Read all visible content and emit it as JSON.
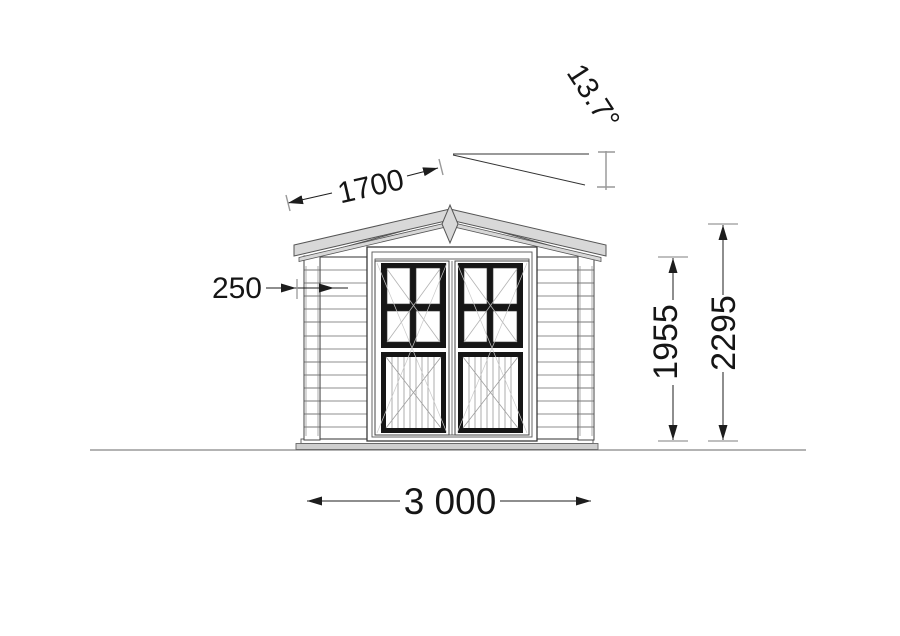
{
  "drawing": {
    "type": "log-cabin front elevation",
    "dimensions": {
      "roof_angle": "13.7°",
      "roof_slope": "1700",
      "corner_offset": "250",
      "wall_height": "1955",
      "ridge_height": "2295",
      "overall_width": "3 000"
    },
    "colors": {
      "line": "#2f2f2f",
      "fascia_fill": "#d8d8d8",
      "base_fill": "#cfcfcf",
      "tick_gray": "#999999",
      "background": "#ffffff"
    }
  }
}
